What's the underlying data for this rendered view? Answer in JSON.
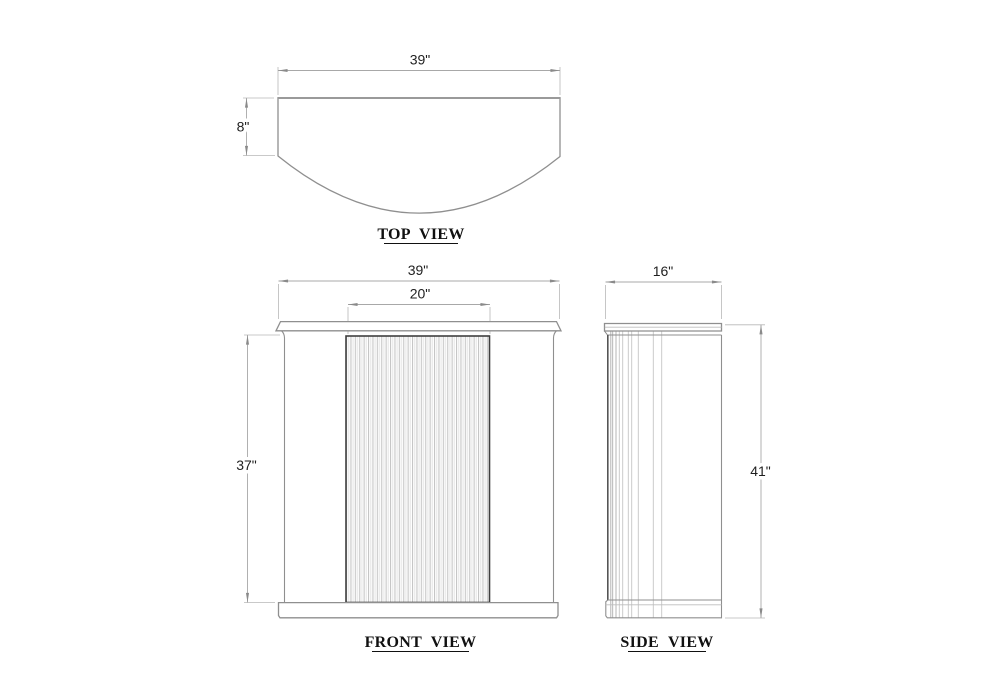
{
  "colors": {
    "ink": "#1f1f1f",
    "outline": "#8f8f8f",
    "dim_line": "#a8a8a8",
    "panel_border": "#3f3f3f"
  },
  "views": {
    "top": {
      "label": "TOP VIEW",
      "width_dim": "39\"",
      "front_depth_dim": "8\""
    },
    "front": {
      "label": "FRONT VIEW",
      "width_dim": "39\"",
      "door_width_dim": "20\"",
      "body_height_dim": "37\""
    },
    "side": {
      "label": "SIDE VIEW",
      "depth_dim": "16\"",
      "overall_height_dim": "41\""
    }
  }
}
